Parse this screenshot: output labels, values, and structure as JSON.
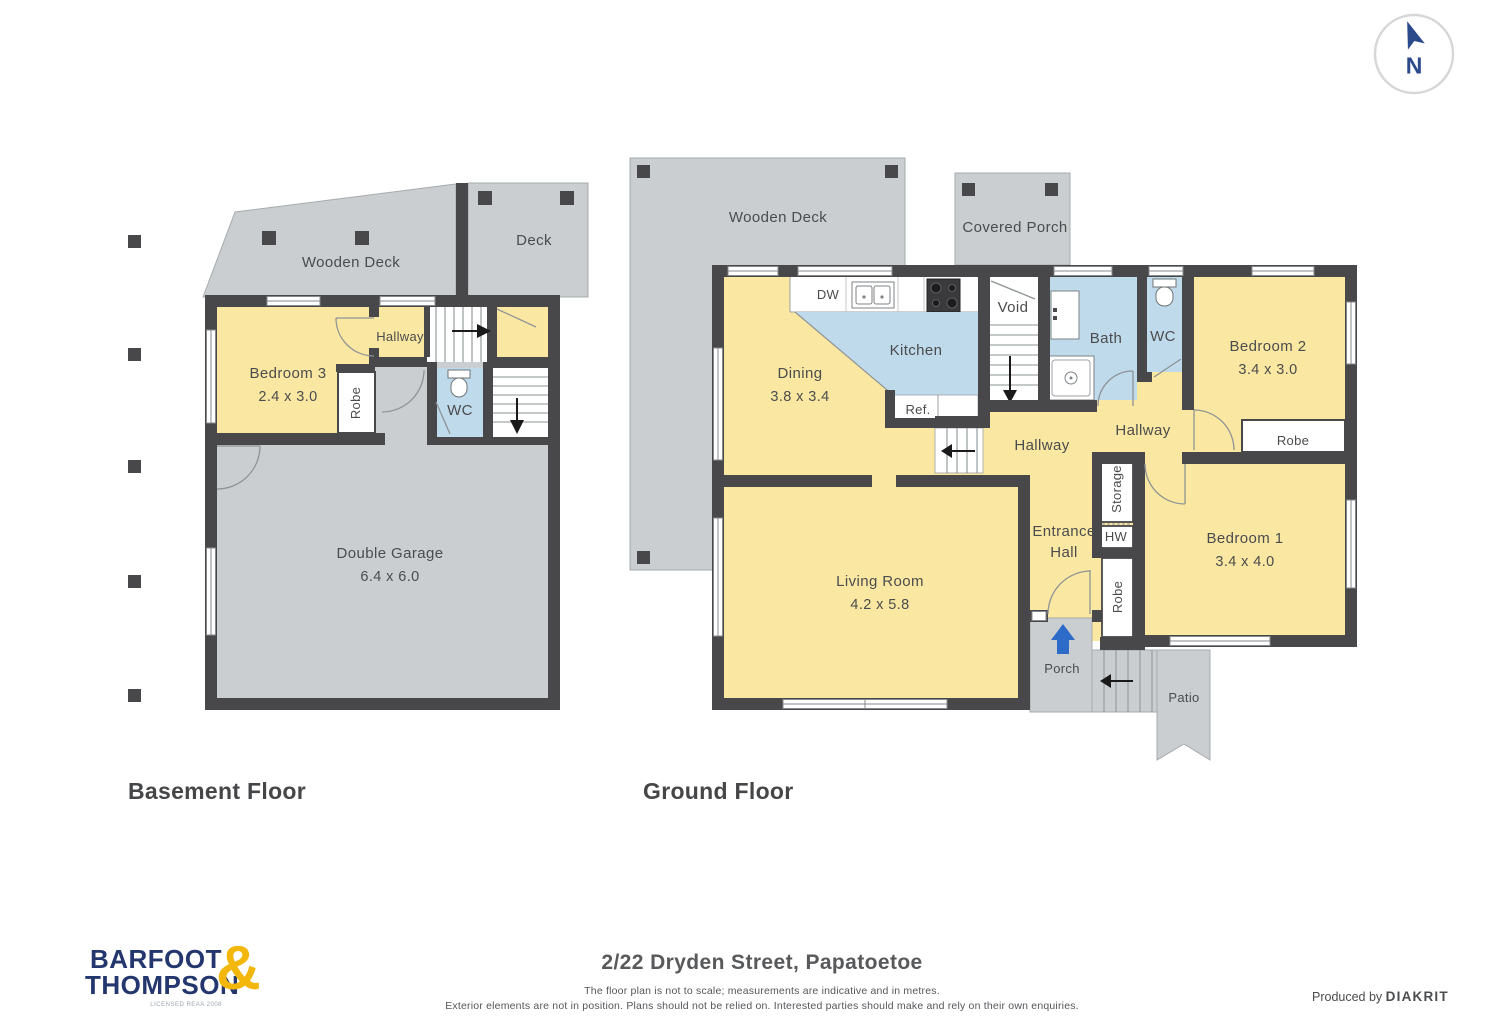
{
  "compass": {
    "n": "N"
  },
  "floors": {
    "basement": {
      "title": "Basement Floor",
      "rooms": {
        "wooden_deck": "Wooden Deck",
        "deck": "Deck",
        "bedroom3_name": "Bedroom 3",
        "bedroom3_dims": "2.4 x 3.0",
        "hallway": "Hallway",
        "robe": "Robe",
        "wc": "WC",
        "garage_name": "Double Garage",
        "garage_dims": "6.4 x 6.0"
      }
    },
    "ground": {
      "title": "Ground Floor",
      "rooms": {
        "wooden_deck": "Wooden Deck",
        "covered_porch": "Covered Porch",
        "dining_name": "Dining",
        "dining_dims": "3.8 x 3.4",
        "kitchen": "Kitchen",
        "dw": "DW",
        "ref": "Ref.",
        "void": "Void",
        "bath": "Bath",
        "wc": "WC",
        "bedroom2_name": "Bedroom 2",
        "bedroom2_dims": "3.4 x 3.0",
        "robe_bedroom2": "Robe",
        "hallway_left": "Hallway",
        "hallway_right": "Hallway",
        "storage": "Storage",
        "hw": "HW",
        "entrance_hall": "Entrance Hall",
        "robe_bedroom1": "Robe",
        "bedroom1_name": "Bedroom 1",
        "bedroom1_dims": "3.4 x 4.0",
        "living_name": "Living Room",
        "living_dims": "4.2 x 5.8",
        "porch": "Porch",
        "patio": "Patio"
      }
    }
  },
  "footer": {
    "address": "2/22 Dryden Street, Papatoetoe",
    "disclaimer_line1": "The floor plan is not to scale; measurements are indicative and in metres.",
    "disclaimer_line2": "Exterior elements are not in position. Plans should not be relied on. Interested parties should make and rely on their own enquiries.",
    "produced_by": "Produced by",
    "producer": "DIAKRIT"
  },
  "branding": {
    "name_line1": "BARFOOT",
    "name_line2": "THOMPSON",
    "ampersand": "&",
    "license": "LICENSED REAA 2008"
  },
  "colors": {
    "room_yellow": "#FAE8A2",
    "wet_blue": "#BFDAEB",
    "outdoor_gray": "#CACED0",
    "wall_dark": "#48484A",
    "brand_navy": "#24366E",
    "brand_gold": "#F2B70A",
    "entry_arrow_blue": "#2E6BC8",
    "compass_navy": "#2B4A8C"
  }
}
